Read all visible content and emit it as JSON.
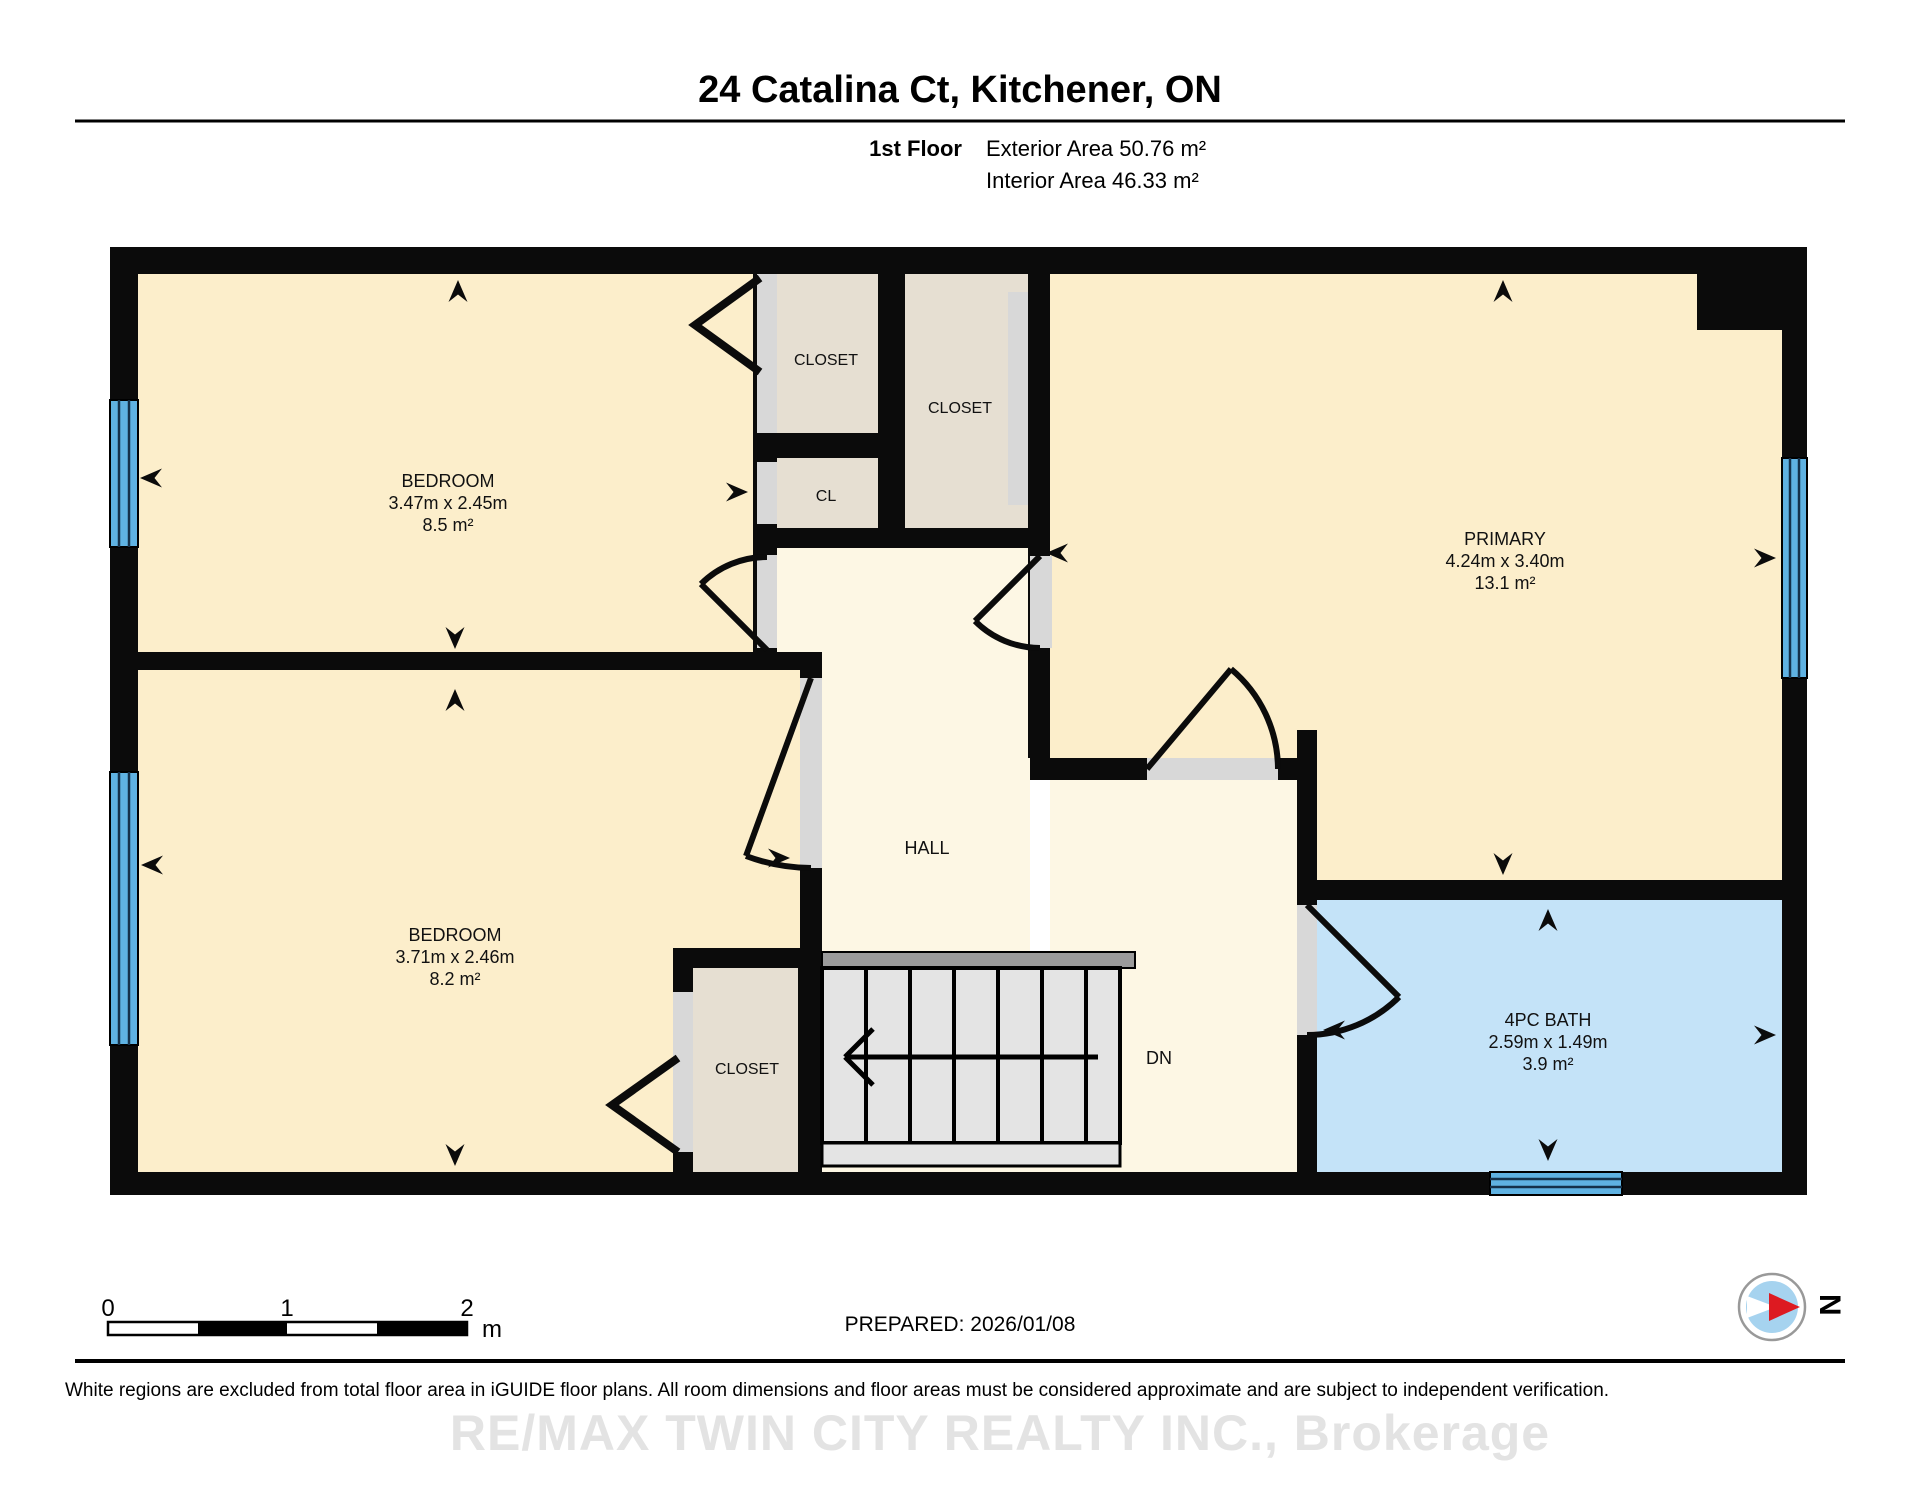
{
  "header": {
    "title": "24 Catalina Ct, Kitchener, ON",
    "floor": "1st Floor",
    "exterior": "Exterior Area 50.76 m²",
    "interior": "Interior Area 46.33 m²"
  },
  "rooms": {
    "bedroom_top": {
      "name": "BEDROOM",
      "dims": "3.47m x 2.45m",
      "area": "8.5 m²"
    },
    "bedroom_bottom": {
      "name": "BEDROOM",
      "dims": "3.71m x 2.46m",
      "area": "8.2 m²"
    },
    "primary": {
      "name": "PRIMARY",
      "dims": "4.24m x 3.40m",
      "area": "13.1 m²"
    },
    "bath": {
      "name": "4PC BATH",
      "dims": "2.59m x 1.49m",
      "area": "3.9 m²"
    },
    "closet_top_left": "CLOSET",
    "closet_top_right": "CLOSET",
    "closet_small": "CL",
    "closet_bottom": "CLOSET",
    "hall": "HALL",
    "stairs_dn": "DN"
  },
  "scale_bar": {
    "t0": "0",
    "t1": "1",
    "t2": "2",
    "unit": "m"
  },
  "compass": {
    "north": "N"
  },
  "footer": {
    "prepared": "PREPARED: 2026/01/08",
    "disclaimer": "White regions are excluded from total floor area in iGUIDE floor plans. All room dimensions and floor areas must be considered approximate and are subject to independent verification.",
    "watermark": "RE/MAX TWIN CITY REALTY INC., Brokerage"
  },
  "colors": {
    "wall": "#0B0B0B",
    "room": "#FCEECB",
    "hall": "#FDF7E4",
    "closet": "#E6DFD2",
    "bath": "#C4E3F8",
    "window": "#5FB2E2",
    "door_gap": "#D8D8D8",
    "stair_tread": "#E4E4E4",
    "stair_rail": "#9B9B9B",
    "compass_blue": "#A6D3EF",
    "compass_red": "#DD1A21"
  }
}
